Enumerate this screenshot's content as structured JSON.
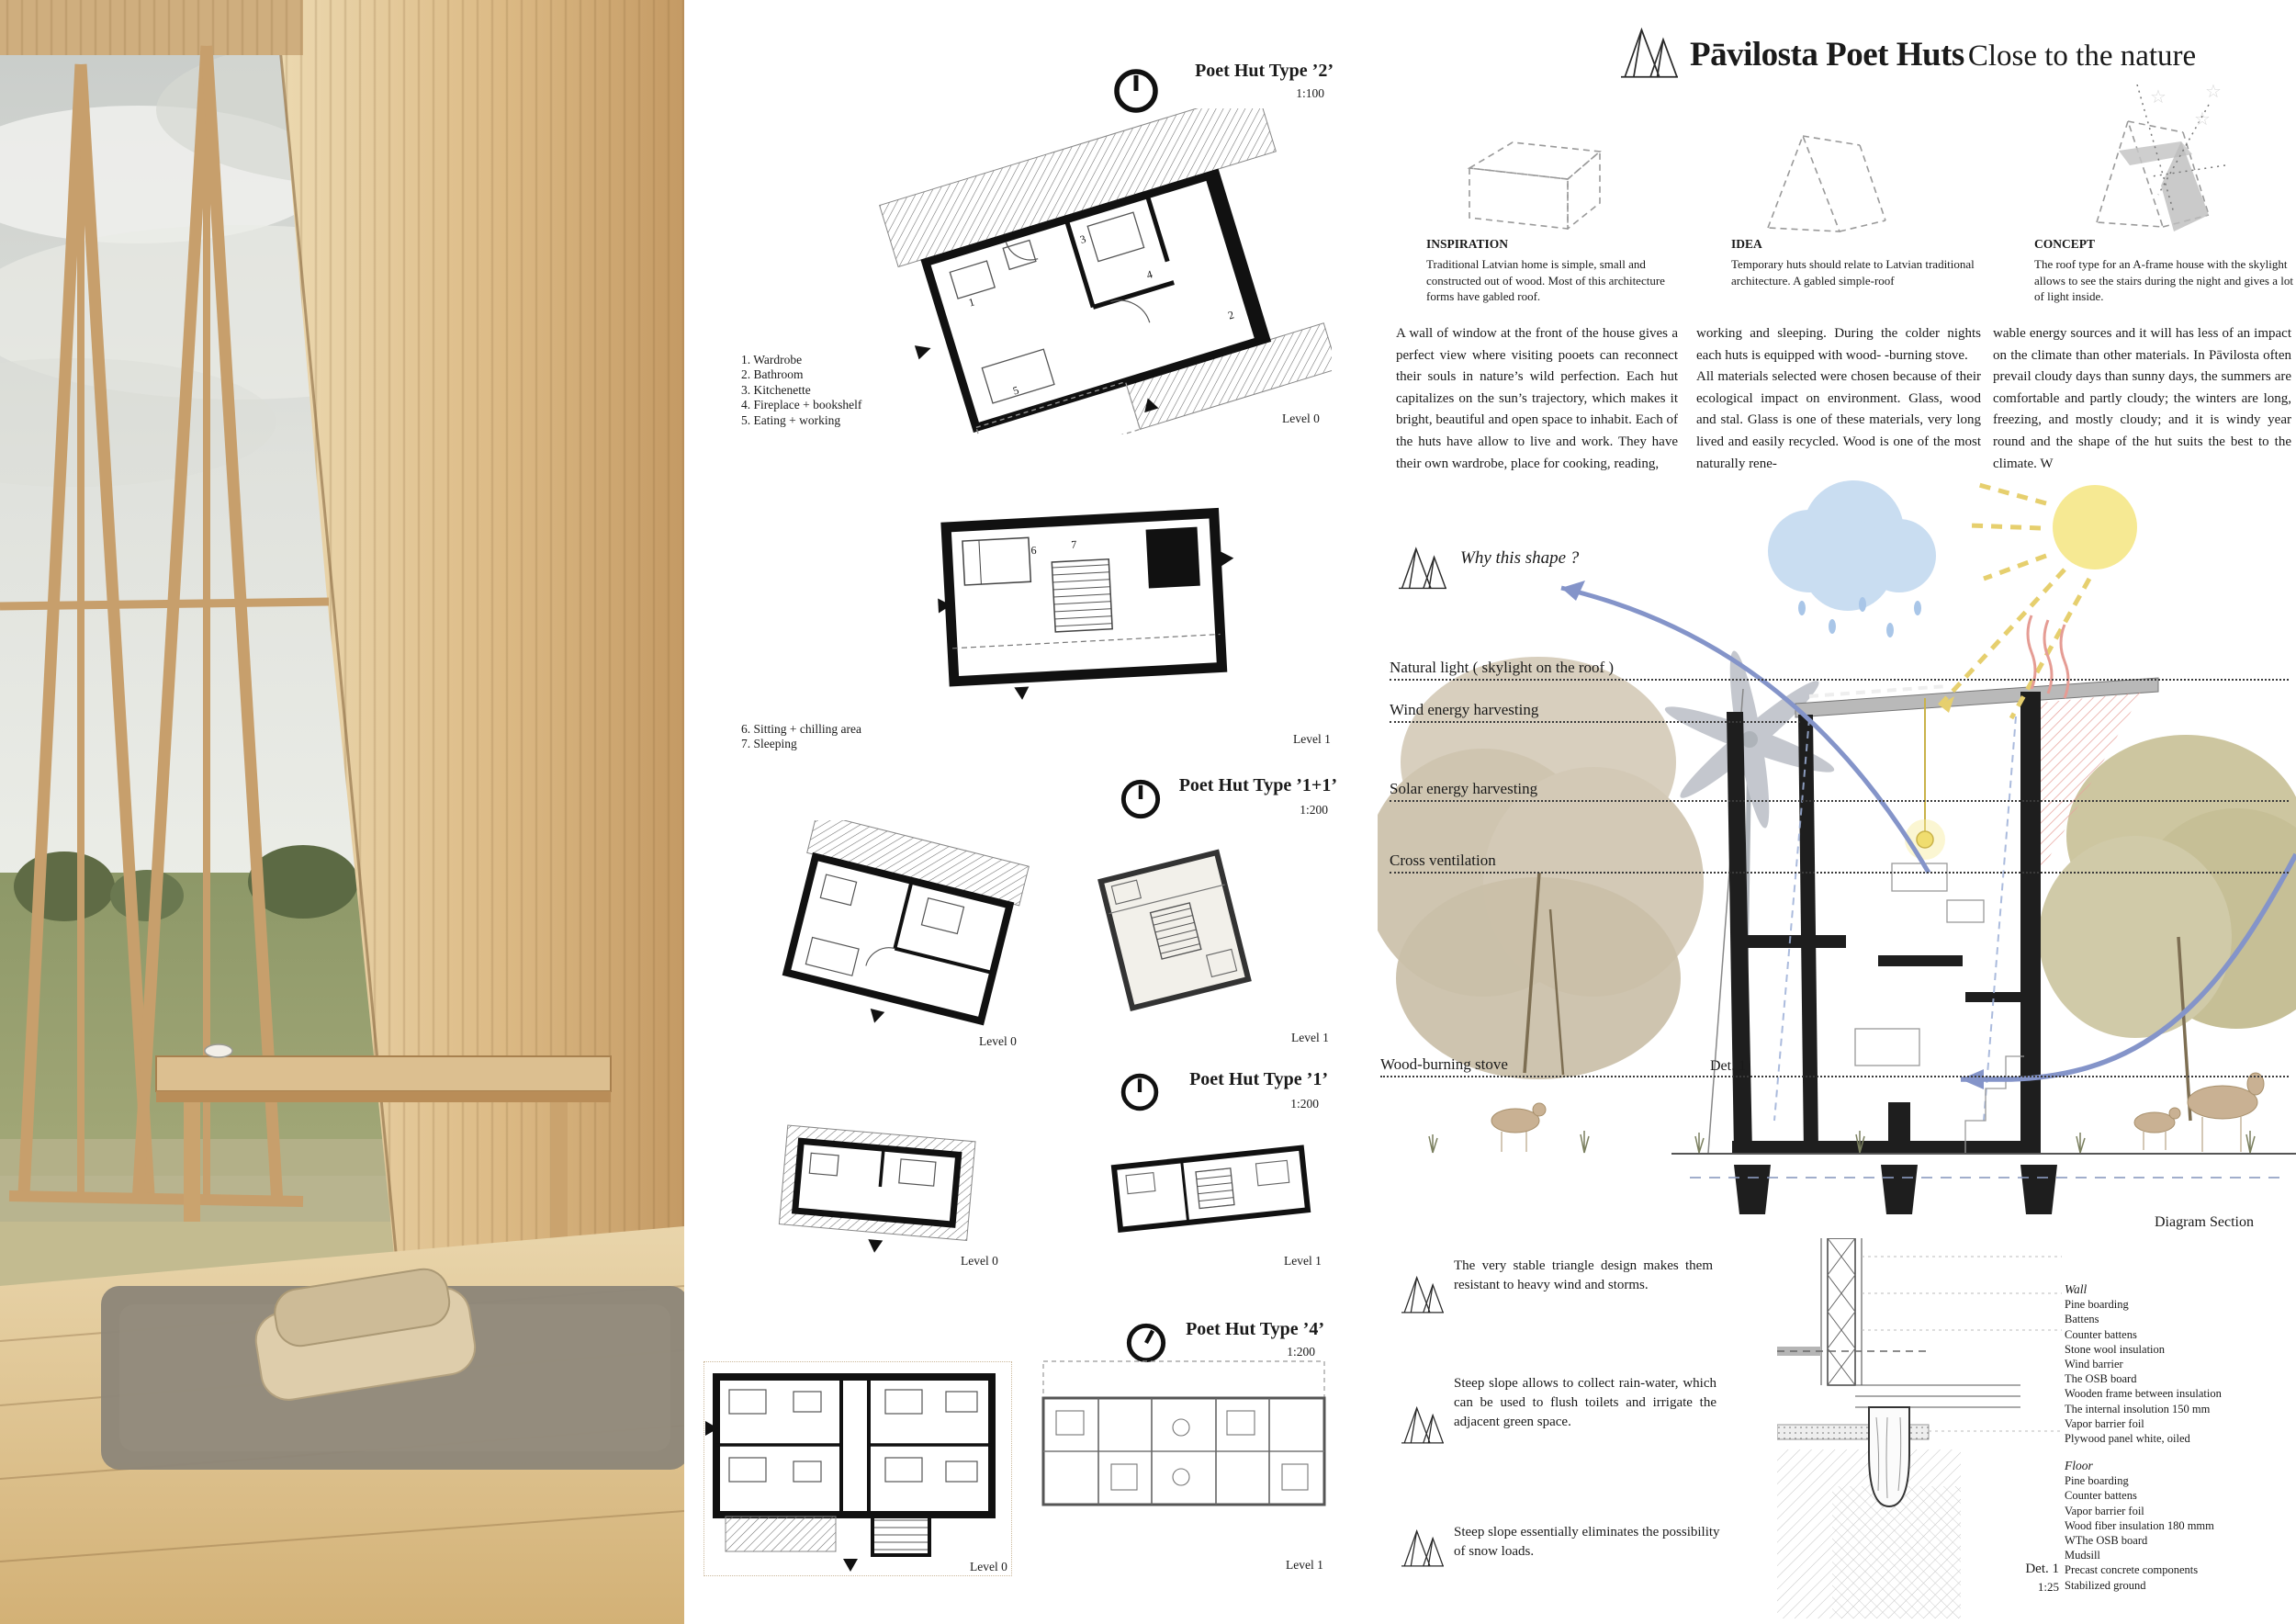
{
  "title": {
    "main": "Pāvilosta Poet Huts",
    "subtitle": "Close to the nature"
  },
  "concepts": [
    {
      "heading": "INSPIRATION",
      "text": "Traditional Latvian home is simple, small and constructed out of wood. Most of this architecture forms have gabled roof."
    },
    {
      "heading": "IDEA",
      "text": "Temporary huts should relate to Latvian traditional architecture. A gabled simple-roof"
    },
    {
      "heading": "CONCEPT",
      "text": "The roof type for an A-frame house with the skylight allows to see the stairs during the night and gives a lot of light inside."
    }
  ],
  "body": {
    "columns": [
      [
        "A wall of window at the front of the house gives a perfect view where visiting pooets can reconnect their souls in nature’s wild perfection. Each hut capitalizes on the sun’s trajectory, which makes it bright, beautiful and open space to inhabit. Each of the huts have allow to live and work. They have their own wardrobe, place for cooking, reading,"
      ],
      [
        "working and sleeping. During the colder nights each huts is equipped with wood- -burning stove.",
        "All materials selected were chosen because of their ecological impact on environment. Glass, wood and stal. Glass is one of these materials, very long lived and easily recycled. Wood is one of the most naturally rene-"
      ],
      [
        "wable energy sources and it will has less of an impact on the climate than other materials. In Pāvilosta often prevail cloudy days than sunny days, the summers are comfortable and partly cloudy; the winters are long, freezing, and mostly cloudy; and it is windy year round and the shape of the hut suits the best to the climate. W"
      ]
    ]
  },
  "plans": {
    "type2": {
      "title": "Poet Hut Type ’2’",
      "scale": "1:100",
      "level0": "Level 0",
      "level1": "Level 1"
    },
    "type11": {
      "title": "Poet Hut Type ’1+1’",
      "scale": "1:200",
      "level0": "Level 0",
      "level1": "Level 1"
    },
    "type1": {
      "title": "Poet Hut Type ’1’",
      "scale": "1:200",
      "level0": "Level 0",
      "level1": "Level 1"
    },
    "type4": {
      "title": "Poet Hut Type ’4’",
      "scale": "1:200",
      "level0": "Level 0",
      "level1": "Level 1"
    },
    "legend_level0": [
      "1. Wardrobe",
      "2. Bathroom",
      "3. Kitchenette",
      "4. Fireplace + bookshelf",
      "5. Eating + working"
    ],
    "legend_level1": [
      "6. Sitting + chilling area",
      "7. Sleeping"
    ],
    "room_numbers": [
      "1",
      "2",
      "3",
      "4",
      "5",
      "6",
      "7"
    ]
  },
  "diagram": {
    "question": "Why this shape ?",
    "labels": [
      "Natural light ( skylight on the roof )",
      "Wind energy harvesting",
      "Solar energy harvesting",
      "Cross ventilation",
      "Wood-burning stove"
    ],
    "detail_marker": "Det. 1",
    "caption": "Diagram Section"
  },
  "features": {
    "items": [
      "The very stable triangle design makes them resistant to heavy wind and storms.",
      "Steep slope allows to collect rain-water, which can be used to flush toilets and irrigate the adjacent green space.",
      "Steep slope essentially eliminates the possibility of snow loads."
    ]
  },
  "detail": {
    "wall_heading": "Wall",
    "wall_items": [
      "Pine boarding",
      "Battens",
      "Counter battens",
      "Stone wool insulation",
      "Wind barrier",
      "The OSB board",
      "Wooden frame between insulation",
      "The internal insolution 150 mm",
      "Vapor barrier foil",
      "Plywood panel white, oiled"
    ],
    "floor_heading": "Floor",
    "floor_items": [
      "Pine boarding",
      "Counter battens",
      "Vapor barrier foil",
      "Wood fiber insulation 180 mmm",
      "WThe OSB board",
      "Mudsill",
      "Precast concrete components",
      "Stabilized ground"
    ],
    "marker": "Det. 1",
    "scale": "1:25"
  },
  "colors": {
    "sun": "#f6e993",
    "cloud": "#c9dcf0",
    "arrow_blue": "#8494c9",
    "tree_beige": "#d5ccba",
    "tree_olive": "#c9c29c",
    "heat_red": "#e59c94",
    "wood": "#d9b988",
    "ink": "#1a1a1a"
  }
}
